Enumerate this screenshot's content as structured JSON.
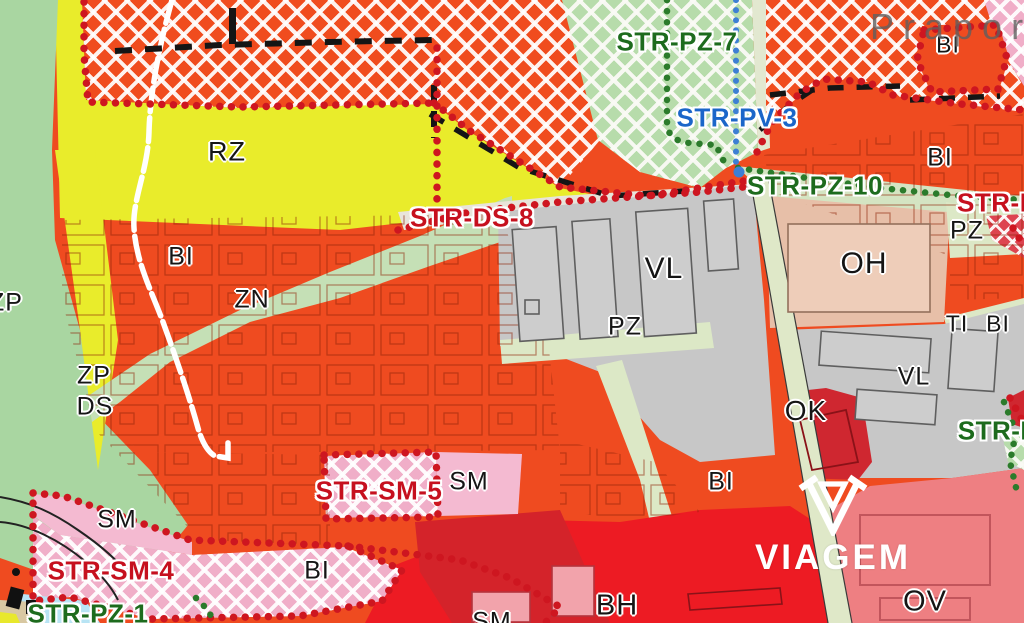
{
  "map": {
    "title": "Urban zoning plan detail",
    "watermark_place": "Praporec",
    "brand": "VIAGEM",
    "zone_labels": [
      {
        "text": "RZ"
      },
      {
        "text": "BI"
      },
      {
        "text": "ZN"
      },
      {
        "text": "ZP"
      },
      {
        "text": "ZP"
      },
      {
        "text": "DS"
      },
      {
        "text": "VL"
      },
      {
        "text": "PZ"
      },
      {
        "text": "OH"
      },
      {
        "text": "PZ"
      },
      {
        "text": "TI"
      },
      {
        "text": "BI"
      },
      {
        "text": "VL"
      },
      {
        "text": "OK"
      },
      {
        "text": "BI"
      },
      {
        "text": "BI"
      },
      {
        "text": "BI"
      },
      {
        "text": "SM"
      },
      {
        "text": "SM"
      },
      {
        "text": "BI"
      },
      {
        "text": "BH"
      },
      {
        "text": "OV"
      },
      {
        "text": "SM"
      }
    ],
    "str_labels": [
      {
        "text": "STR-PZ-7",
        "color": "green"
      },
      {
        "text": "STR-PV-3",
        "color": "blue"
      },
      {
        "text": "STR-PZ-10",
        "color": "green"
      },
      {
        "text": "STR-B",
        "color": "red"
      },
      {
        "text": "STR-DS-8",
        "color": "red"
      },
      {
        "text": "STR-SM-5",
        "color": "red"
      },
      {
        "text": "STR-SM-4",
        "color": "red"
      },
      {
        "text": "STR-PZ-1",
        "color": "green"
      },
      {
        "text": "STR-P",
        "color": "green"
      }
    ],
    "colors": {
      "bi_orange": "#ef4b20",
      "rz_yellow": "#e9ec2b",
      "zp_green": "#a9d6a1",
      "zn_green": "#c5e0b6",
      "pz_pale_green": "#dce8c6",
      "vl_gray": "#c7c7c7",
      "oh_beige": "#e7bfa8",
      "ok_dark_red": "#cf2730",
      "ov_salmon": "#ee7f82",
      "bh_red": "#ed1b23",
      "sm_pink": "#f4bad1",
      "water_blue": "#b8e4f4",
      "boundary_red_dots": "#ce1620",
      "boundary_green_dots": "#2b7b2b",
      "boundary_blue_dots": "#3d7fd4",
      "str_green": "#1d6b1d",
      "str_red": "#c6101e",
      "str_blue": "#1b66c9"
    }
  }
}
